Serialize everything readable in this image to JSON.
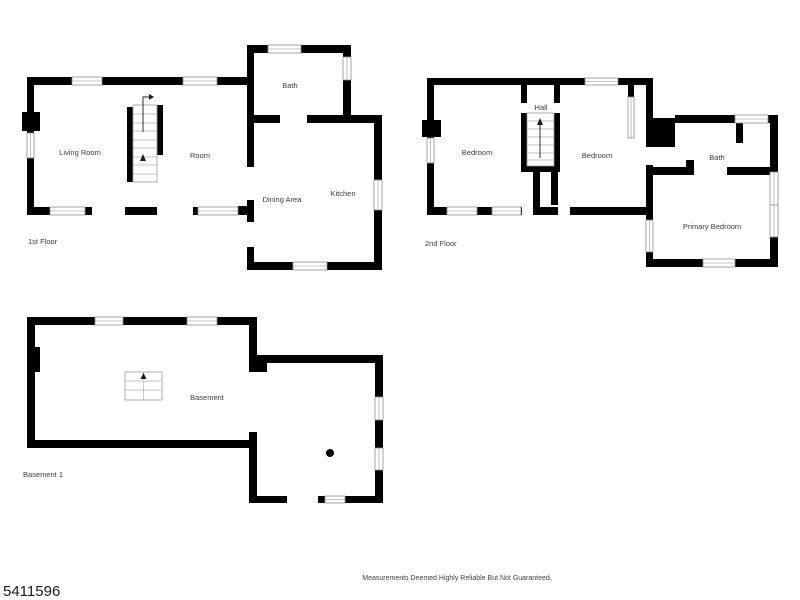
{
  "page": {
    "background": "#ffffff"
  },
  "colors": {
    "wall": "#000000",
    "room_label": "#3d3d3d",
    "window_outline": "#8f8f8f",
    "column_dot": "#000000"
  },
  "floors": [
    {
      "name": "1st Floor",
      "rooms": [
        {
          "label": "Living Room"
        },
        {
          "label": "Room"
        },
        {
          "label": "Bath"
        },
        {
          "label": "Dining Area"
        },
        {
          "label": "Kitchen"
        }
      ]
    },
    {
      "name": "2nd Floor",
      "rooms": [
        {
          "label": "Bedroom"
        },
        {
          "label": "Hall"
        },
        {
          "label": "Bedroom"
        },
        {
          "label": "Bath"
        },
        {
          "label": "Primary Bedroom"
        }
      ]
    },
    {
      "name": "Basement 1",
      "rooms": [
        {
          "label": "Basement"
        }
      ]
    }
  ],
  "footer": {
    "disclaimer": "Measurements Deemed Highly Reliable But Not Guaranteed."
  },
  "listing": {
    "number": "5411596"
  }
}
